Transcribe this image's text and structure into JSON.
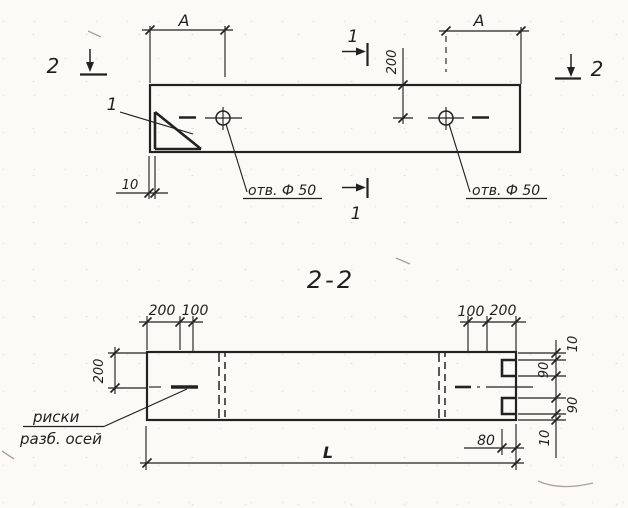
{
  "plan_view": {
    "dim_a_left": "A",
    "dim_a_right": "A",
    "section1_top": "1",
    "section1_bottom": "1",
    "section2_left": "2",
    "section2_right": "2",
    "detail_label": "1",
    "dim_edge_10": "10",
    "dim_hole_offset_200": "200",
    "hole_left_label": "отв. Ф 50",
    "hole_right_label": "отв. Ф 50"
  },
  "section_view": {
    "title": "2-2",
    "top_left_dims": [
      "200",
      "100"
    ],
    "top_right_dims": [
      "100",
      "200"
    ],
    "height_dim": "200",
    "end_dims": [
      "10",
      "90",
      "90",
      "10"
    ],
    "notch_depth_dim": "80",
    "length_dim": "L",
    "axis_marks_line1": "риски",
    "axis_marks_line2": "разб. осей"
  },
  "colors": {
    "ink": "#222220",
    "paper": "#fbfaf6"
  }
}
